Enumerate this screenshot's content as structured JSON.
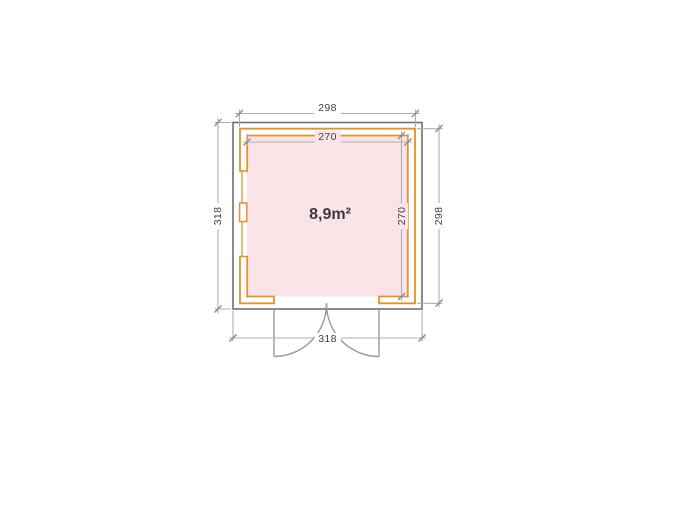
{
  "diagram": {
    "type": "floor-plan",
    "product": "garden-house-plan",
    "area_label": "8,9m²",
    "dimensions": {
      "wall_outer_width_top": "298",
      "interior_width_top": "270",
      "overall_depth_left": "318",
      "interior_depth_right": "270",
      "wall_outer_depth_right": "298",
      "overall_width_bottom": "318"
    },
    "features": {
      "door": "double-swing-door-bottom-center",
      "window": "double-window-left-wall"
    },
    "colors": {
      "wall_outline": "#e2922e",
      "interior_fill": "#fbe4e8",
      "roof_outline": "#6f6f6f",
      "door_lines": "#9a9a9a",
      "dimension_lines": "#afafaf",
      "tick_marks": "#8c8c8c",
      "label_text": "#3f3f3f",
      "background": "#ffffff"
    }
  }
}
